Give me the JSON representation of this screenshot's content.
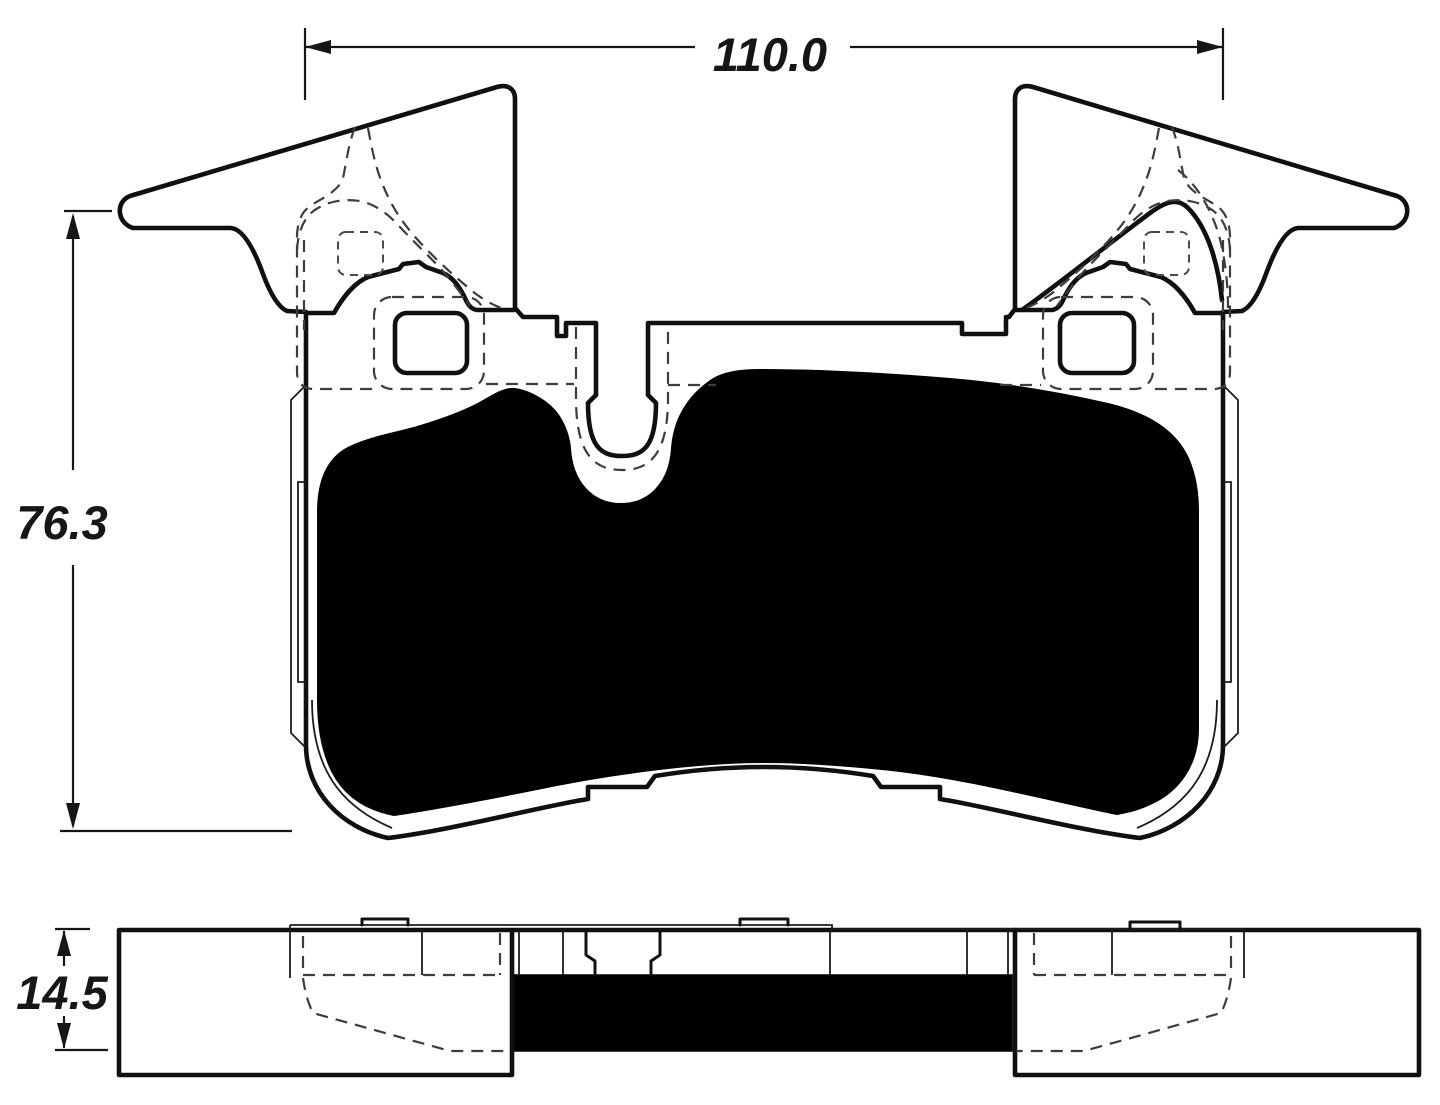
{
  "drawing": {
    "dimensions": {
      "width": {
        "label": "110.0"
      },
      "height": {
        "label": "76.3"
      },
      "thickness": {
        "label": "14.5"
      }
    },
    "colors": {
      "line": "#101010",
      "hidden_line": "#3d3d3d",
      "pad_fill": "#000000",
      "background": "#ffffff"
    }
  }
}
